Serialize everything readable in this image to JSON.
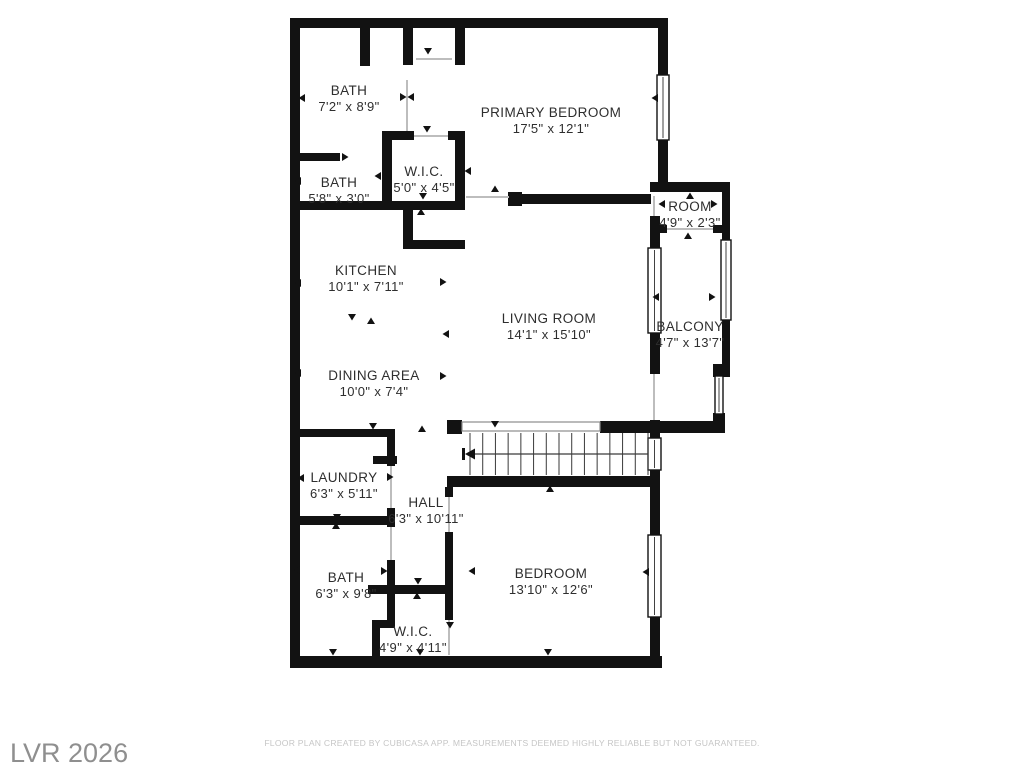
{
  "title": "Floor Plan",
  "colors": {
    "background": "#ffffff",
    "wall": "#121212",
    "label_text": "#2e2e2e",
    "watermark_text": "#8f8f8f",
    "disclaimer_text": "#c6c6c6"
  },
  "rooms": [
    {
      "name": "BATH",
      "dims": "7'2\" x 8'9\""
    },
    {
      "name": "PRIMARY BEDROOM",
      "dims": "17'5\" x 12'1\""
    },
    {
      "name": "W.I.C.",
      "dims": "5'0\" x 4'5\""
    },
    {
      "name": "BATH",
      "dims": "5'8\" x 3'0\""
    },
    {
      "name": "ROOM",
      "dims": "4'9\" x 2'3\""
    },
    {
      "name": "KITCHEN",
      "dims": "10'1\" x 7'11\""
    },
    {
      "name": "LIVING ROOM",
      "dims": "14'1\" x 15'10\""
    },
    {
      "name": "BALCONY",
      "dims": "4'7\" x 13'7\""
    },
    {
      "name": "DINING AREA",
      "dims": "10'0\" x 7'4\""
    },
    {
      "name": "LAUNDRY",
      "dims": "6'3\" x 5'11\""
    },
    {
      "name": "HALL",
      "dims": "6'3\" x 10'11\""
    },
    {
      "name": "BATH",
      "dims": "6'3\" x 9'8\""
    },
    {
      "name": "BEDROOM",
      "dims": "13'10\" x 12'6\""
    },
    {
      "name": "W.I.C.",
      "dims": "4'9\" x 4'11\""
    }
  ],
  "footer": {
    "watermark": "LVR 2026",
    "disclaimer": "FLOOR PLAN CREATED BY CUBICASA APP. MEASUREMENTS DEEMED HIGHLY RELIABLE BUT NOT GUARANTEED."
  }
}
